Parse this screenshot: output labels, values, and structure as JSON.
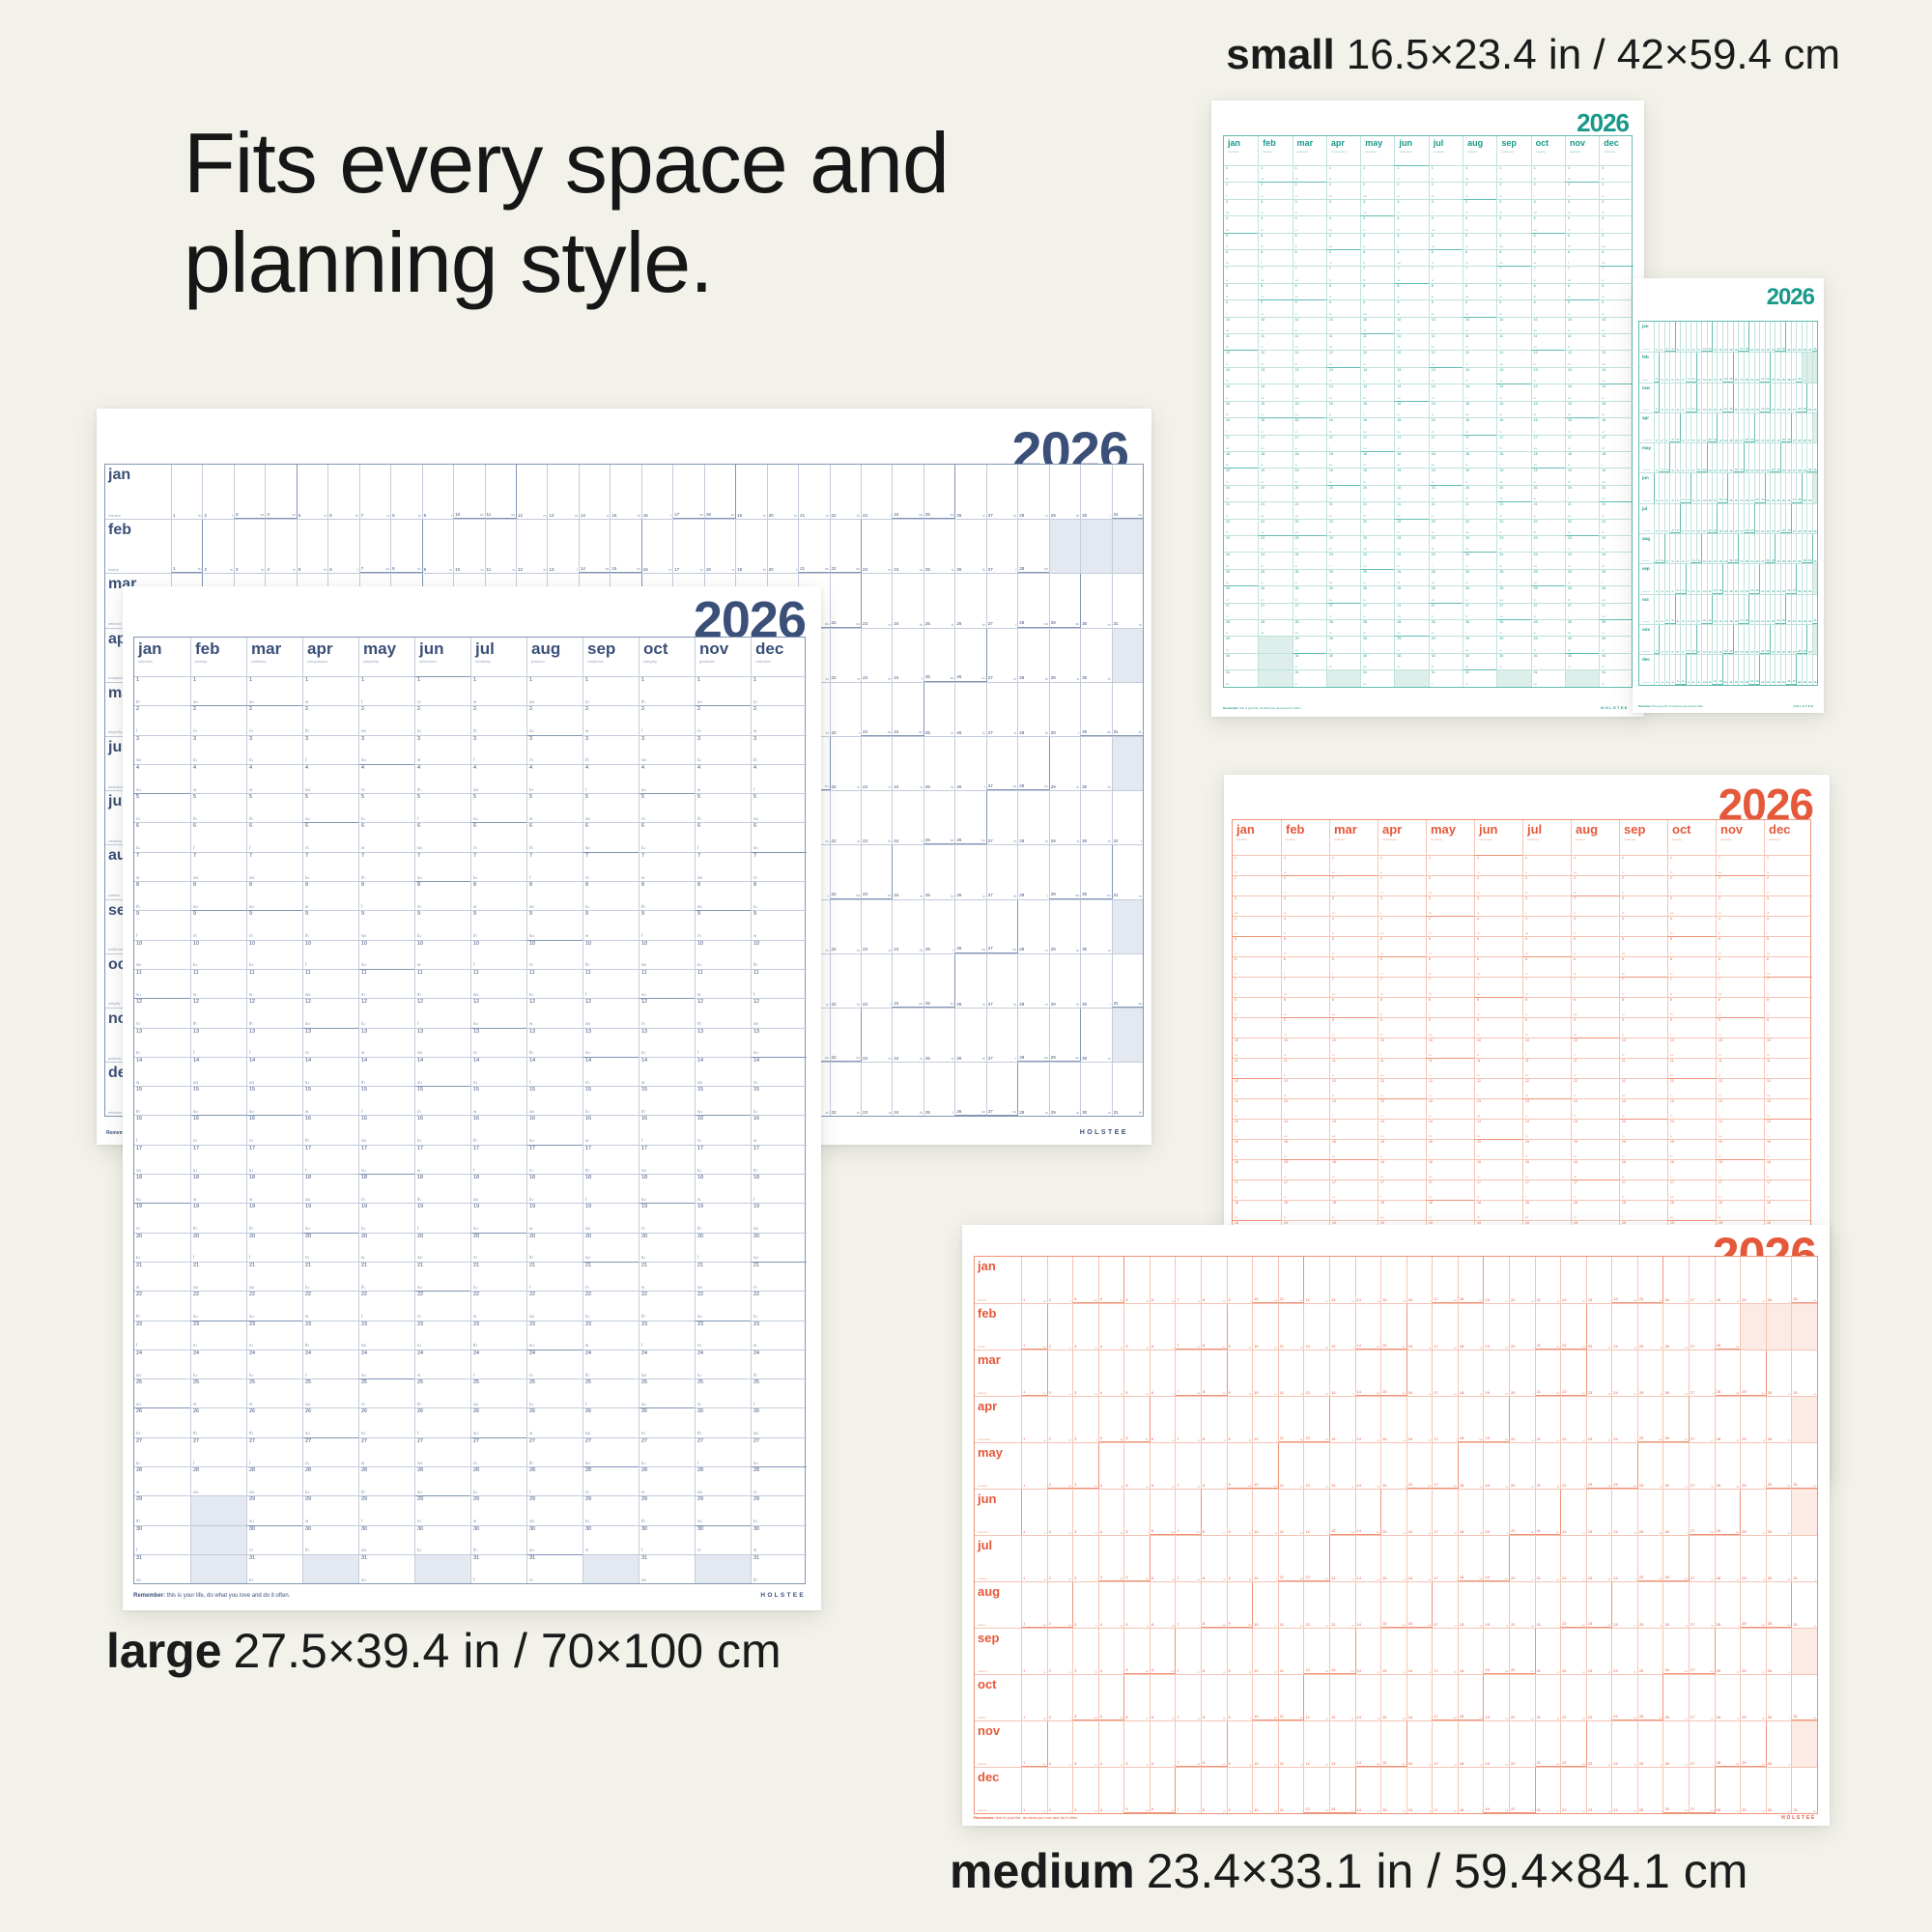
{
  "page": {
    "background": "#f2f2ea"
  },
  "headline": {
    "line1": "Fits every space and",
    "line2": "planning style."
  },
  "size_labels": {
    "small": {
      "name": "small",
      "dims": "16.5×23.4 in / 42×59.4 cm"
    },
    "large": {
      "name": "large",
      "dims": "27.5×39.4 in / 70×100 cm"
    },
    "medium": {
      "name": "medium",
      "dims": "23.4×33.1 in / 59.4×84.1 cm"
    }
  },
  "calendar": {
    "year": "2026",
    "months": [
      "jan",
      "feb",
      "mar",
      "apr",
      "may",
      "jun",
      "jul",
      "aug",
      "sep",
      "oct",
      "nov",
      "dec"
    ],
    "themes": [
      "intention",
      "kinship",
      "wellness",
      "compassion",
      "simplicity",
      "adventure",
      "creativity",
      "passion",
      "resilience",
      "integrity",
      "gratitude",
      "reflection"
    ],
    "days_in_month": [
      31,
      28,
      31,
      30,
      31,
      30,
      31,
      31,
      30,
      31,
      30,
      31
    ],
    "jan1_weekday_index": 3,
    "weekday_letters": [
      "m",
      "tu",
      "w",
      "th",
      "f",
      "sa",
      "su"
    ],
    "footer_note_bold": "Remember:",
    "footer_note_rest": "this is your life, do what you love and do it often.",
    "brand": "HOLSTEE"
  },
  "palettes": {
    "navy": {
      "ink": "#3b5078",
      "soft": "#8295b4",
      "gridline": "#c3cbdb",
      "light": "#e4e8f0",
      "theme_ink": "#98a6c0"
    },
    "teal": {
      "ink": "#18998a",
      "soft": "#63bdb1",
      "gridline": "#bfe2dc",
      "light": "#ddefeb",
      "theme_ink": "#86cabf"
    },
    "orange": {
      "ink": "#e5583a",
      "soft": "#ef9377",
      "gridline": "#f5c4b4",
      "light": "#fcebe4",
      "theme_ink": "#f2a288"
    }
  },
  "posters": {
    "teal_portrait": {
      "palette": "teal",
      "layout": "columns",
      "show_footer": true
    },
    "teal_landscape": {
      "palette": "teal",
      "layout": "rows",
      "show_footer": true
    },
    "navy_landscape": {
      "palette": "navy",
      "layout": "rows",
      "show_footer": true
    },
    "navy_portrait": {
      "palette": "navy",
      "layout": "columns",
      "show_footer": true
    },
    "orange_portrait": {
      "palette": "orange",
      "layout": "columns",
      "show_footer": false
    },
    "orange_landscape": {
      "palette": "orange",
      "layout": "rows",
      "show_footer": true
    }
  }
}
